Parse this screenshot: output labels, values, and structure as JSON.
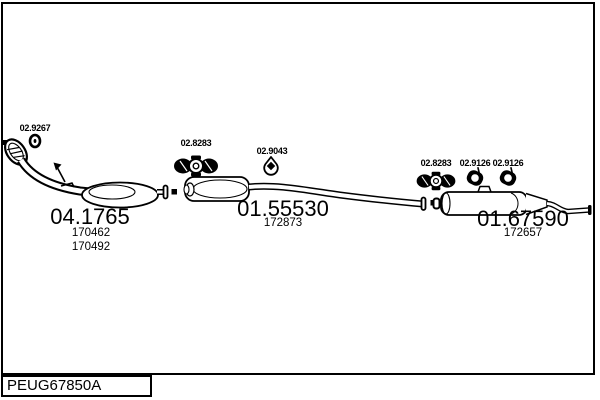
{
  "window": {
    "background": "#ffffff",
    "line_color": "#000000",
    "type": "exhaust-system-parts-diagram"
  },
  "parts": {
    "gasket": {
      "label": "02.9267",
      "icon": "gasket-ring-icon"
    },
    "front_pipe": {
      "label": "04.1765",
      "ref1": "170462",
      "ref2": "170492"
    },
    "mount_mid": {
      "label": "02.8283",
      "icon": "rubber-mount-icon"
    },
    "hanger_mid": {
      "label": "02.9043",
      "icon": "hanger-bracket-icon"
    },
    "centre_muffler": {
      "label": "01.55530",
      "ref1": "172873"
    },
    "mount_rear": {
      "label": "02.8283",
      "icon": "rubber-mount-icon"
    },
    "ring_hanger_1": {
      "label": "02.9126",
      "icon": "ring-hanger-icon"
    },
    "ring_hanger_2": {
      "label": "02.9126",
      "icon": "ring-hanger-icon"
    },
    "rear_muffler": {
      "label": "01.67590",
      "ref1": "172657"
    }
  },
  "footer": {
    "code": "PEUG67850A"
  }
}
